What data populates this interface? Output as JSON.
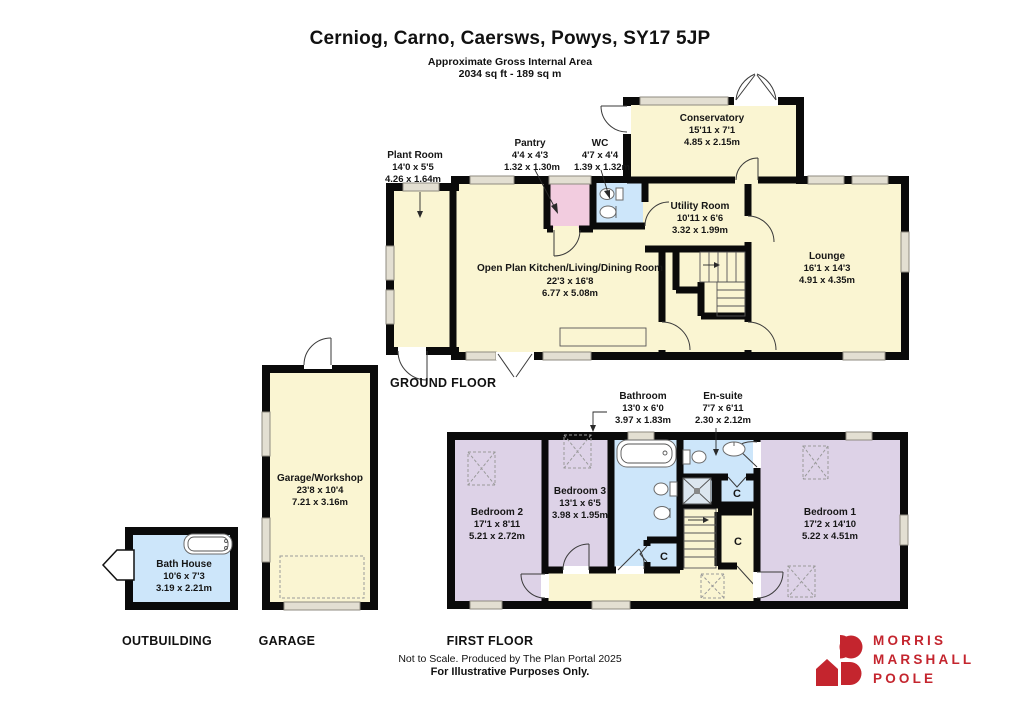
{
  "header": {
    "title": "Cerniog, Carno, Caersws, Powys, SY17 5JP",
    "subtitle1": "Approximate Gross Internal Area",
    "subtitle2": "2034 sq ft - 189 sq m"
  },
  "sections": {
    "ground_floor": "GROUND FLOOR",
    "first_floor": "FIRST FLOOR",
    "outbuilding": "OUTBUILDING",
    "garage": "GARAGE"
  },
  "rooms": {
    "plant_room": {
      "name": "Plant Room",
      "imperial": "14'0 x 5'5",
      "metric": "4.26 x 1.64m"
    },
    "pantry": {
      "name": "Pantry",
      "imperial": "4'4 x 4'3",
      "metric": "1.32 x 1.30m"
    },
    "wc": {
      "name": "WC",
      "imperial": "4'7 x 4'4",
      "metric": "1.39 x 1.32m"
    },
    "conservatory": {
      "name": "Conservatory",
      "imperial": "15'11 x 7'1",
      "metric": "4.85 x 2.15m"
    },
    "utility": {
      "name": "Utility Room",
      "imperial": "10'11 x 6'6",
      "metric": "3.32 x 1.99m"
    },
    "kitchen": {
      "name": "Open Plan Kitchen/Living/Dining Room",
      "imperial": "22'3 x 16'8",
      "metric": "6.77 x 5.08m"
    },
    "lounge": {
      "name": "Lounge",
      "imperial": "16'1 x 14'3",
      "metric": "4.91 x 4.35m"
    },
    "garage": {
      "name": "Garage/Workshop",
      "imperial": "23'8 x 10'4",
      "metric": "7.21 x 3.16m"
    },
    "bath_house": {
      "name": "Bath House",
      "imperial": "10'6 x 7'3",
      "metric": "3.19 x 2.21m"
    },
    "bathroom": {
      "name": "Bathroom",
      "imperial": "13'0 x 6'0",
      "metric": "3.97 x 1.83m"
    },
    "ensuite": {
      "name": "En-suite",
      "imperial": "7'7 x 6'11",
      "metric": "2.30 x 2.12m"
    },
    "bedroom1": {
      "name": "Bedroom 1",
      "imperial": "17'2 x 14'10",
      "metric": "5.22 x 4.51m"
    },
    "bedroom2": {
      "name": "Bedroom 2",
      "imperial": "17'1 x 8'11",
      "metric": "5.21 x 2.72m"
    },
    "bedroom3": {
      "name": "Bedroom 3",
      "imperial": "13'1 x 6'5",
      "metric": "3.98 x 1.95m"
    }
  },
  "closet_label": "C",
  "footer": {
    "line1": "Not to Scale. Produced by The Plan Portal 2025",
    "line2": "For Illustrative Purposes Only."
  },
  "logo": {
    "line1": "MORRIS",
    "line2": "MARSHALL",
    "line3": "POOLE"
  },
  "colors": {
    "wall": "#0A0A0A",
    "room_cream": "#FAF5D2",
    "room_purple": "#DDD2E7",
    "room_blue": "#CDE6FA",
    "room_pink": "#F2CCDF",
    "window_gray": "#E3DFD2",
    "logo_red": "#C4252E"
  }
}
